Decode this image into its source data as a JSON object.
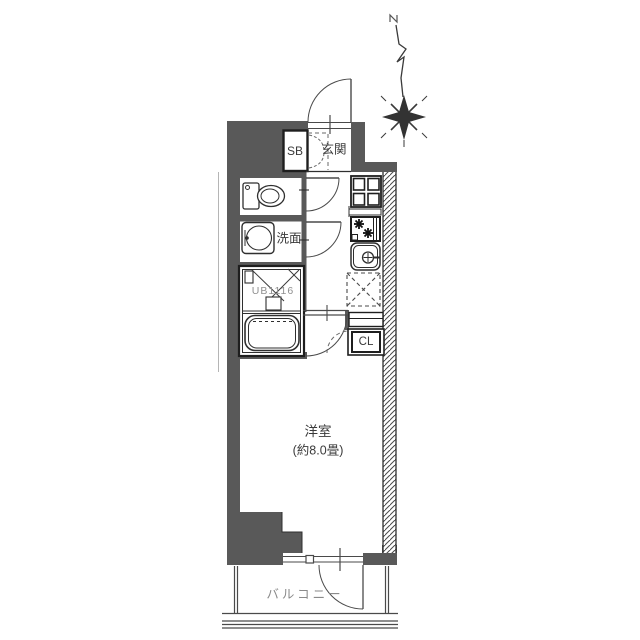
{
  "floor_plan": {
    "labels": {
      "shoe_box": "SB",
      "entrance": "玄関",
      "washroom": "洗面",
      "unit_bath": "UB1116",
      "closet": "CL",
      "main_room": "洋室",
      "main_room_size": "(約8.0畳)",
      "balcony": "バルコニー"
    },
    "colors": {
      "wall": "#595959",
      "line": "#2f2f2f",
      "hatch": "#4a4a4a",
      "text": "#3a3a3a",
      "muted_text": "#8a8a8a",
      "background": "#ffffff"
    },
    "icons": {
      "north-arrow-icon": "zigzag needle with four-point compass star",
      "toilet-icon": "toilet tank and bowl",
      "vanity-sink-icon": "washroom basin",
      "bathtub-icon": "unit bath tub",
      "washing-machine-pan-icon": "square pan with four panes",
      "stove-icon": "two burner stove",
      "kitchen-sink-icon": "sink with faucet",
      "refrigerator-space-icon": "dashed square with X",
      "door-swing-arc": "quarter-circle door swing"
    }
  }
}
